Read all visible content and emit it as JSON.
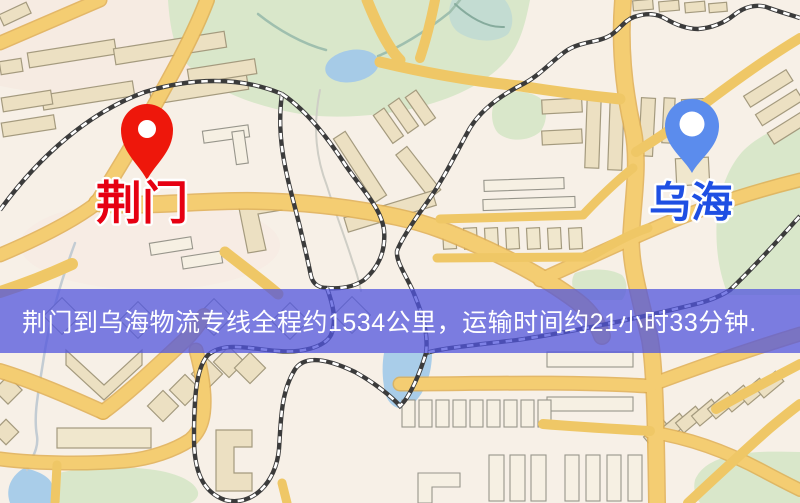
{
  "banner": {
    "text": "荆门到乌海物流专线全程约1534公里，运输时间约21小时33分钟.",
    "background_color": "rgba(82,86,222,0.75)",
    "text_color": "#ffffff"
  },
  "markers": {
    "origin": {
      "label": "荆门",
      "pin_color": "#ee170b",
      "label_color": "#e60012"
    },
    "destination": {
      "label": "乌海",
      "pin_color": "#5b8ced",
      "label_color": "#1e4fe3"
    }
  },
  "map": {
    "palette": {
      "background": "#f7f0e7",
      "road": "#f4cd72",
      "road_casing": "#dfae52",
      "building": "#ece0c2",
      "building_outline": "#a49a7e",
      "green_area": "#d9e7ca",
      "water": "#a9cde9",
      "railway": "#3b3b3b"
    }
  }
}
